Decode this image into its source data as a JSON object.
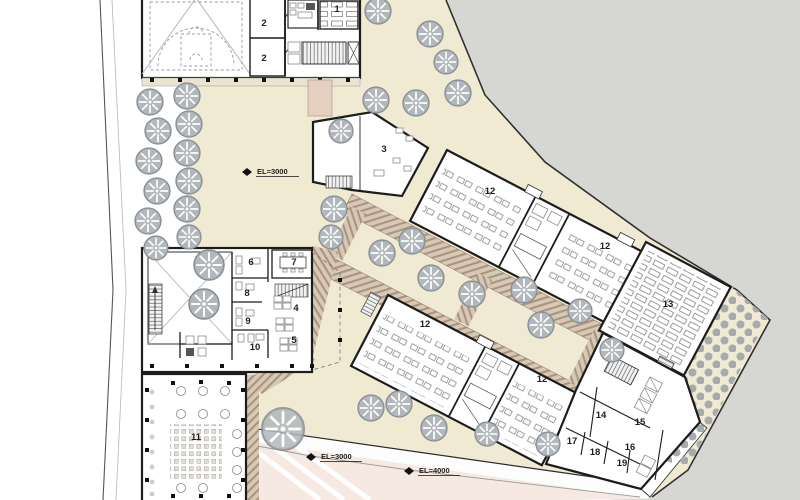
{
  "plan": {
    "room_labels": [
      {
        "id": "lecture-hall",
        "label": "1"
      },
      {
        "id": "gym-room-a",
        "label": "2"
      },
      {
        "id": "gym-room-b",
        "label": "2"
      },
      {
        "id": "entrance-hall",
        "label": "3"
      },
      {
        "id": "open-office",
        "label": "4"
      },
      {
        "id": "office-cluster",
        "label": "5"
      },
      {
        "id": "office-a",
        "label": "6"
      },
      {
        "id": "meeting-room",
        "label": "7"
      },
      {
        "id": "office-b",
        "label": "8"
      },
      {
        "id": "office-c",
        "label": "9"
      },
      {
        "id": "office-d",
        "label": "10"
      },
      {
        "id": "cafeteria",
        "label": "11"
      },
      {
        "id": "classroom-a1",
        "label": "12"
      },
      {
        "id": "classroom-a2",
        "label": "12"
      },
      {
        "id": "classroom-b1",
        "label": "12"
      },
      {
        "id": "classroom-b2",
        "label": "12"
      },
      {
        "id": "library-hall",
        "label": "13"
      },
      {
        "id": "room-14",
        "label": "14"
      },
      {
        "id": "room-15",
        "label": "15"
      },
      {
        "id": "room-16",
        "label": "16"
      },
      {
        "id": "room-17",
        "label": "17"
      },
      {
        "id": "room-18",
        "label": "18"
      },
      {
        "id": "room-19",
        "label": "19"
      }
    ],
    "elevation_markers": [
      {
        "label": "EL=3000"
      },
      {
        "label": "EL=3000"
      },
      {
        "label": "EL=4000"
      }
    ],
    "colors": {
      "site_ground": "#f1ead2",
      "outside": "#d6d6d2",
      "walkway": "#d8c9b6",
      "walkway_stripe": "#aa947e",
      "road_pink": "#f6e9e1",
      "tree": "#b2b7bc",
      "wall": "#1c1c1c"
    }
  }
}
